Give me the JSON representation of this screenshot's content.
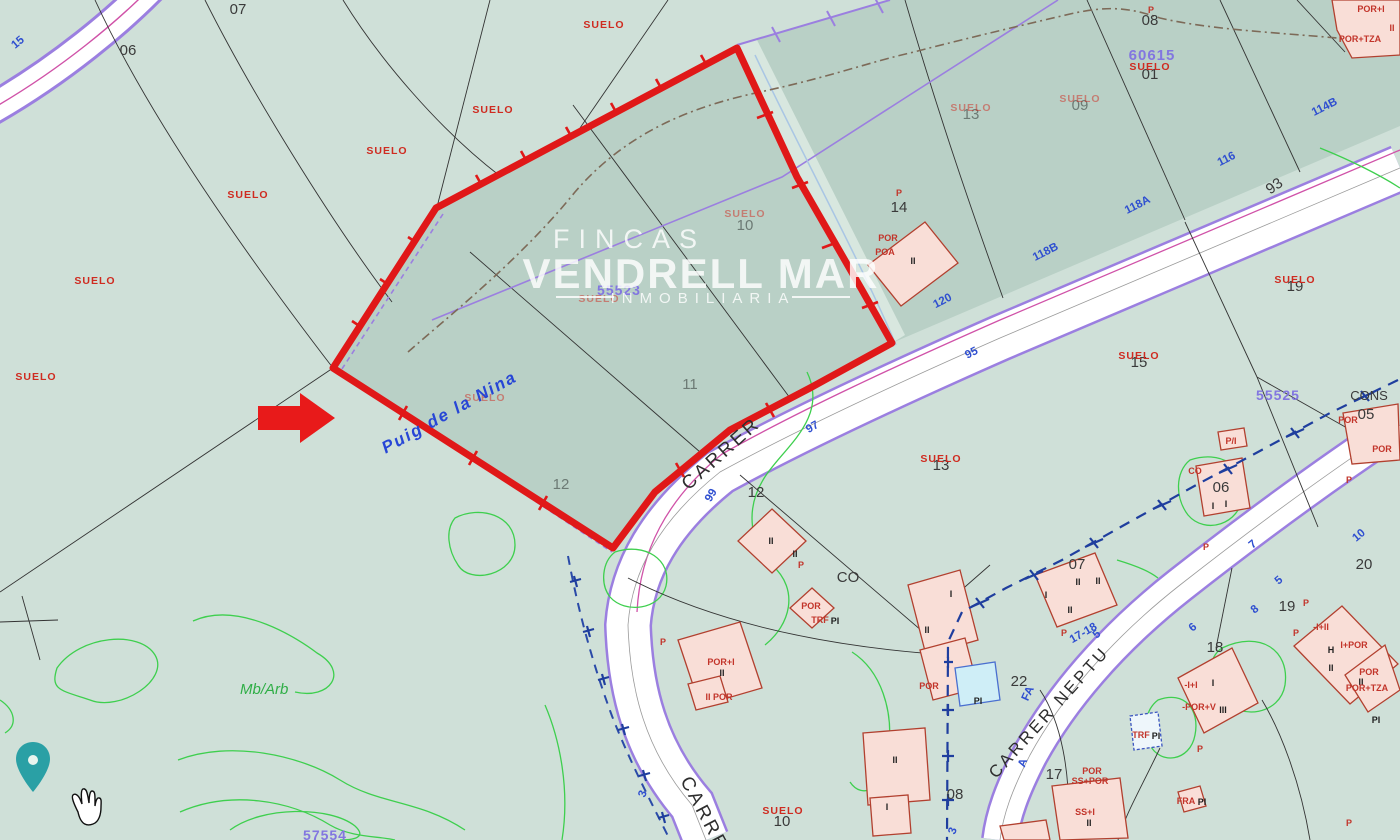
{
  "watermark": {
    "brand_top": "FINCAS",
    "brand_main": "VENDRELL MAR",
    "brand_sub": "INMOBILIARIA"
  },
  "map": {
    "suelo_text": "SUELO",
    "toponym": "Puig de la Nina",
    "vegetation": "Mb/Arb",
    "street_names": [
      "CARRER",
      "CARRER NEPTU",
      "CARRER"
    ],
    "block_numbers": [
      "60615",
      "55523",
      "55525",
      "57554"
    ],
    "parcel_labels": [
      "07",
      "06",
      "08",
      "01",
      "09",
      "13",
      "14",
      "10",
      "11",
      "12",
      "12",
      "13",
      "15",
      "19",
      "19",
      "20",
      "22",
      "17",
      "18",
      "07",
      "08",
      "05",
      "06",
      "CO",
      "CONS",
      "93",
      "10"
    ],
    "road_numbers": [
      "15",
      "114B",
      "116",
      "118A",
      "118B",
      "120",
      "95",
      "97",
      "99",
      "17-18",
      "FA",
      "A",
      "5",
      "6",
      "8",
      "3",
      "10",
      "7",
      "5",
      "3"
    ],
    "building_labels": [
      "POR+I",
      "II",
      "POR+TZA",
      "P",
      "P",
      "POR",
      "POA",
      "II",
      "P",
      "POR+I",
      "II",
      "II POR",
      "II",
      "II",
      "P",
      "POR",
      "TRF",
      "PI",
      "I",
      "II",
      "POR",
      "PI",
      "II",
      "I",
      "I",
      "II",
      "II",
      "II",
      "P",
      "TRF",
      "PI",
      "FRA",
      "PI",
      "-I+I",
      "I",
      "-POR+V",
      "III",
      "P",
      "-I+II",
      "H",
      "I+POR",
      "II",
      "POR",
      "II",
      "POR+TZA",
      "PI",
      "P",
      "CO",
      "P/I",
      "I",
      "I",
      "POR",
      "POR",
      "P",
      "P",
      "POR",
      "SS+POR",
      "SS+I",
      "II",
      "P",
      "P"
    ],
    "colors": {
      "highlight_red": "#e01818",
      "cadastral_purple": "#8f7fe8",
      "road_number_blue": "#2f4fd0",
      "suelo_red": "#cf2b20",
      "contour_green": "#3ecf4e",
      "pin_teal": "#2aa0a5"
    }
  }
}
